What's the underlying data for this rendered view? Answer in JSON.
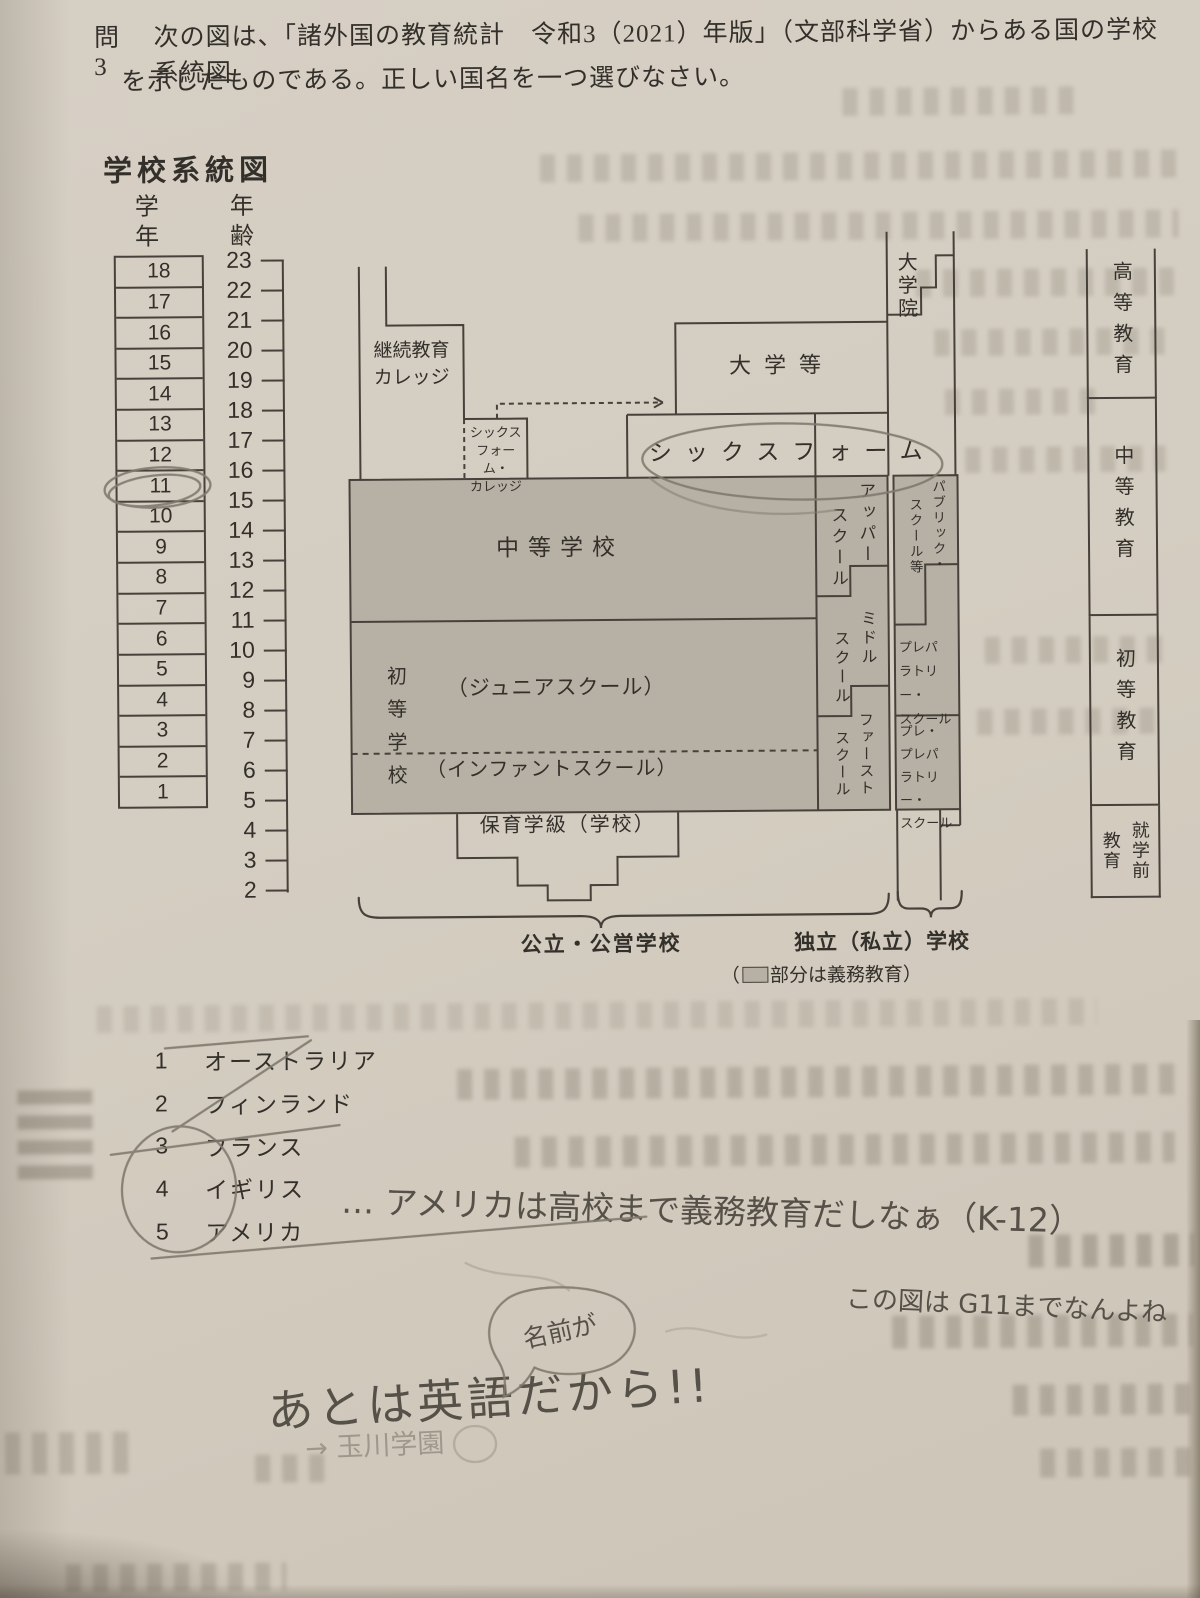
{
  "question": {
    "label": "問3",
    "line1": "次の図は、「諸外国の教育統計　令和3（2021）年版」（文部科学省）からある国の学校系統図",
    "line2": "を示したものである。正しい国名を一つ選びなさい。"
  },
  "figure": {
    "title": "学校系統図",
    "grade_header": "学年",
    "age_header": "年齢",
    "grades": [
      18,
      17,
      16,
      15,
      14,
      13,
      12,
      11,
      10,
      9,
      8,
      7,
      6,
      5,
      4,
      3,
      2,
      1
    ],
    "ages": [
      23,
      22,
      21,
      20,
      19,
      18,
      17,
      16,
      15,
      14,
      13,
      12,
      11,
      10,
      9,
      8,
      7,
      6,
      5,
      4,
      3,
      2
    ],
    "boxes": {
      "fe_college": [
        "継続教育",
        "カレッジ"
      ],
      "sixth_form_college": [
        "シックス",
        "フォーム・",
        "カレッジ"
      ],
      "university": "大学等",
      "grad_school": "大学院",
      "sixth_form": "シックスフォーム",
      "secondary": "中等学校",
      "primary": "初等学校",
      "junior": "（ジュニアスクール）",
      "infant": "（インファントスクール）",
      "nursery": "保育学級（学校）",
      "upper": [
        "アッパー",
        "スクール"
      ],
      "middle": [
        "ミドル",
        "スクール"
      ],
      "first": [
        "ファースト",
        "スクール"
      ],
      "public_school": [
        "パブリック・",
        "スクール等"
      ],
      "prep": [
        "プレパ",
        "ラトリー・",
        "スクール"
      ],
      "pre_prep": [
        "プレ・",
        "プレパ",
        "ラトリー・",
        "スクール"
      ]
    },
    "stages": {
      "higher": "高等教育",
      "secondary": "中等教育",
      "primary": "初等教育",
      "preschool": [
        "就学前",
        "教育"
      ]
    },
    "sectors": {
      "public": "公立・公営学校",
      "private": "独立（私立）学校",
      "note_prefix": "（",
      "note_suffix": "部分は義務教育）"
    }
  },
  "options": [
    {
      "num": "1",
      "label": "オーストラリア"
    },
    {
      "num": "2",
      "label": "フィンランド"
    },
    {
      "num": "3",
      "label": "フランス"
    },
    {
      "num": "4",
      "label": "イギリス"
    },
    {
      "num": "5",
      "label": "アメリカ"
    }
  ],
  "handwriting": {
    "memo_k12": "… アメリカは高校まで義務教育だしなぁ（K-12）",
    "memo_g11": "この図は G11までなんよね",
    "bubble": "名前が",
    "memo_english": "あとは英語だから!!",
    "memo_tamagawa": "→ 玉川学園"
  },
  "colors": {
    "paper": "#d3ccc0",
    "compulsory_gray": "#b7b1a5",
    "line": "#46413a",
    "pencil": "#80796d"
  }
}
